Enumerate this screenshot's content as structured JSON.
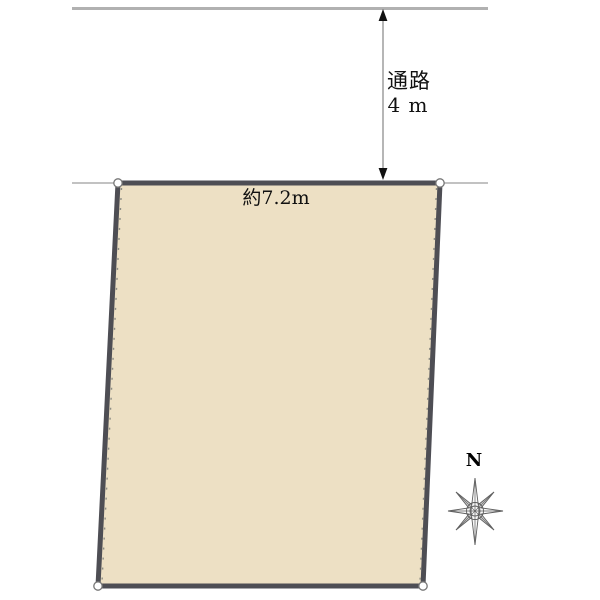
{
  "diagram": {
    "passage": {
      "label": "通路",
      "value": "4 m"
    },
    "frontage": {
      "label": "約7.2m"
    },
    "compass": {
      "north_label": "N"
    }
  },
  "colors": {
    "plot_fill": "#EDE0C4",
    "plot_border": "#4E4E54",
    "guide_line_top": "#B1B1B1",
    "guide_line_base": "#9E9E9E",
    "arrow_shaft": "#8F8F8F",
    "arrow_head": "#111111",
    "corner_marker_fill": "#FFFFFF",
    "corner_marker_stroke": "#767676",
    "compass_line": "#5F5F5F"
  }
}
